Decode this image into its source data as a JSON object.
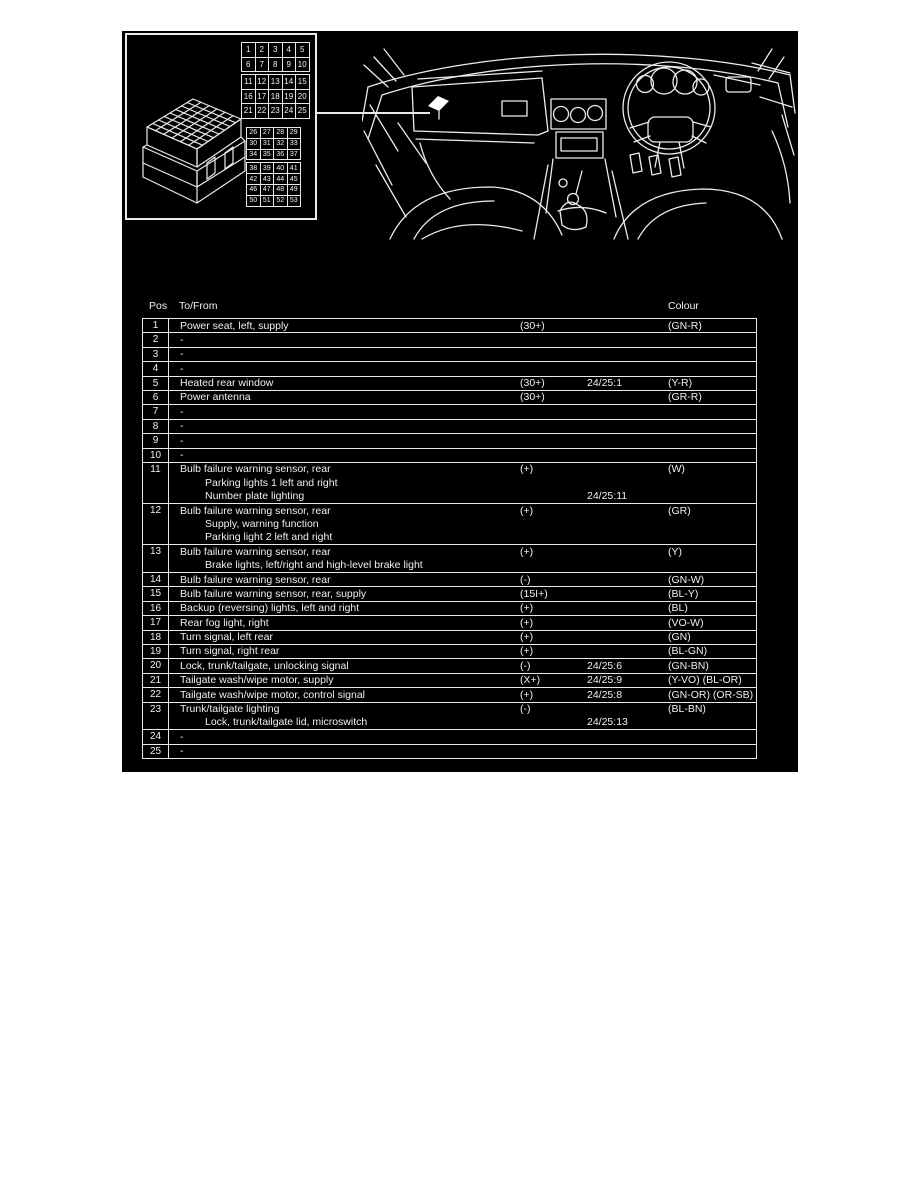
{
  "colors": {
    "page_bg": "#ffffff",
    "panel_bg": "#000000",
    "ink": "#ededed"
  },
  "connector": {
    "grid_a_rows": [
      [
        "1",
        "2",
        "3",
        "4",
        "5"
      ],
      [
        "6",
        "7",
        "8",
        "9",
        "10"
      ],
      [
        "11",
        "12",
        "13",
        "14",
        "15"
      ],
      [
        "16",
        "17",
        "18",
        "19",
        "20"
      ],
      [
        "21",
        "22",
        "23",
        "24",
        "25"
      ]
    ],
    "grid_b_rows": [
      [
        "26",
        "27",
        "28",
        "29"
      ],
      [
        "30",
        "31",
        "32",
        "33"
      ],
      [
        "34",
        "35",
        "36",
        "37"
      ],
      [
        "38",
        "39",
        "40",
        "41"
      ],
      [
        "42",
        "43",
        "44",
        "45"
      ],
      [
        "46",
        "47",
        "48",
        "49"
      ],
      [
        "50",
        "51",
        "52",
        "53"
      ]
    ]
  },
  "table": {
    "header": {
      "pos": "Pos",
      "to_from": "To/From",
      "colour": "Colour"
    },
    "rows": [
      {
        "pos": "1",
        "lines": [
          {
            "text": "Power seat, left, supply",
            "signal": "(30+)",
            "colour": "(GN-R)"
          }
        ]
      },
      {
        "pos": "2",
        "lines": [
          {
            "text": "-"
          }
        ]
      },
      {
        "pos": "3",
        "lines": [
          {
            "text": "-"
          }
        ]
      },
      {
        "pos": "4",
        "lines": [
          {
            "text": "-"
          }
        ]
      },
      {
        "pos": "5",
        "lines": [
          {
            "text": "Heated rear window",
            "signal": "(30+)",
            "ref": "24/25:1",
            "colour": "(Y-R)"
          }
        ]
      },
      {
        "pos": "6",
        "lines": [
          {
            "text": "Power antenna",
            "signal": "(30+)",
            "colour": "(GR-R)"
          }
        ]
      },
      {
        "pos": "7",
        "lines": [
          {
            "text": "-"
          }
        ]
      },
      {
        "pos": "8",
        "lines": [
          {
            "text": "-"
          }
        ]
      },
      {
        "pos": "9",
        "lines": [
          {
            "text": "-"
          }
        ]
      },
      {
        "pos": "10",
        "lines": [
          {
            "text": "-"
          }
        ]
      },
      {
        "pos": "11",
        "lines": [
          {
            "text": "Bulb failure warning sensor, rear",
            "signal": "(+)",
            "colour": "(W)"
          },
          {
            "text": "Parking lights 1 left and right",
            "indent": true
          },
          {
            "text": "Number plate lighting",
            "indent": true,
            "ref": "24/25:11"
          }
        ]
      },
      {
        "pos": "12",
        "lines": [
          {
            "text": "Bulb failure warning sensor, rear",
            "signal": "(+)",
            "colour": "(GR)"
          },
          {
            "text": "Supply, warning function",
            "indent": true
          },
          {
            "text": "Parking light 2 left and right",
            "indent": true
          }
        ]
      },
      {
        "pos": "13",
        "lines": [
          {
            "text": "Bulb failure warning sensor, rear",
            "signal": "(+)",
            "colour": "(Y)"
          },
          {
            "text": "Brake lights, left/right and high-level brake light",
            "indent": true
          }
        ]
      },
      {
        "pos": "14",
        "lines": [
          {
            "text": "Bulb failure warning sensor, rear",
            "signal": "(-)",
            "colour": "(GN-W)"
          }
        ]
      },
      {
        "pos": "15",
        "lines": [
          {
            "text": "Bulb failure warning sensor, rear, supply",
            "signal": "(15I+)",
            "colour": "(BL-Y)"
          }
        ]
      },
      {
        "pos": "16",
        "lines": [
          {
            "text": "Backup (reversing) lights, left and right",
            "signal": "(+)",
            "colour": "(BL)"
          }
        ]
      },
      {
        "pos": "17",
        "lines": [
          {
            "text": "Rear fog light, right",
            "signal": "(+)",
            "colour": "(VO-W)"
          }
        ]
      },
      {
        "pos": "18",
        "lines": [
          {
            "text": "Turn signal, left rear",
            "signal": "(+)",
            "colour": "(GN)"
          }
        ]
      },
      {
        "pos": "19",
        "lines": [
          {
            "text": "Turn signal, right rear",
            "signal": "(+)",
            "colour": "(BL-GN)"
          }
        ]
      },
      {
        "pos": "20",
        "lines": [
          {
            "text": "Lock, trunk/tailgate, unlocking signal",
            "signal": "(-)",
            "ref": "24/25:6",
            "colour": "(GN-BN)"
          }
        ]
      },
      {
        "pos": "21",
        "lines": [
          {
            "text": "Tailgate wash/wipe motor, supply",
            "signal": "(X+)",
            "ref": "24/25:9",
            "colour": "(Y-VO) (BL-OR)"
          }
        ]
      },
      {
        "pos": "22",
        "lines": [
          {
            "text": "Tailgate wash/wipe motor, control signal",
            "signal": "(+)",
            "ref": "24/25:8",
            "colour": "(GN-OR) (OR-SB)"
          }
        ]
      },
      {
        "pos": "23",
        "lines": [
          {
            "text": "Trunk/tailgate lighting",
            "signal": "(-)",
            "colour": "(BL-BN)"
          },
          {
            "text": "Lock, trunk/tailgate lid, microswitch",
            "indent": true,
            "ref": "24/25:13"
          }
        ]
      },
      {
        "pos": "24",
        "lines": [
          {
            "text": "-"
          }
        ]
      },
      {
        "pos": "25",
        "lines": [
          {
            "text": "-"
          }
        ]
      }
    ]
  }
}
